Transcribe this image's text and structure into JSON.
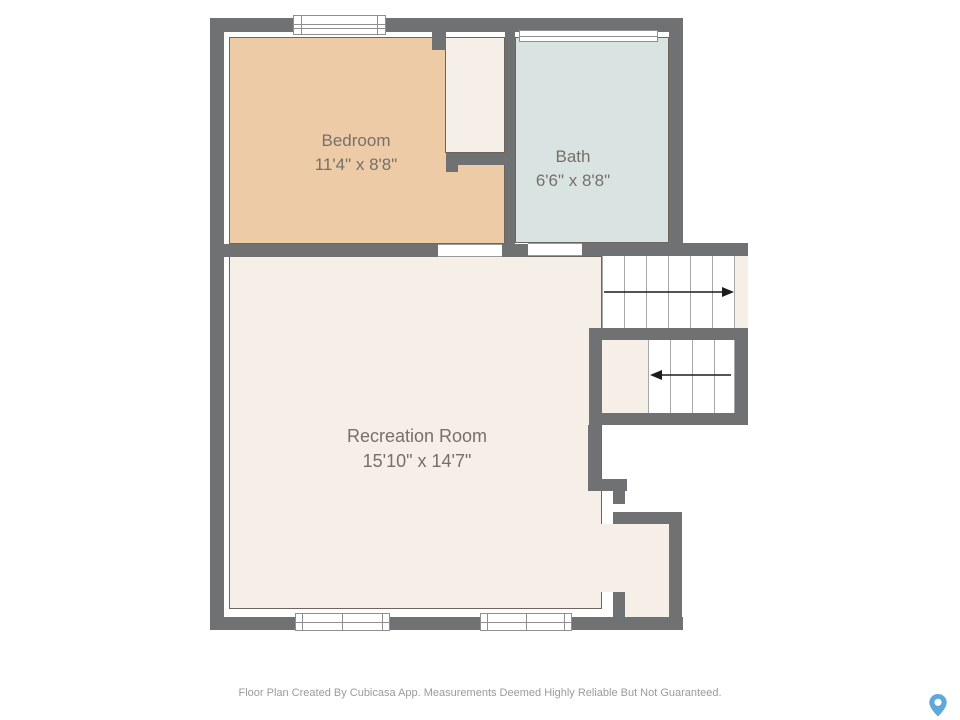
{
  "floor_plan": {
    "rooms": {
      "bedroom": {
        "name": "Bedroom",
        "dimensions": "11'4\" x 8'8\"",
        "fill": "#edcba6"
      },
      "bath": {
        "name": "Bath",
        "dimensions": "6'6\" x 8'8\"",
        "fill": "#d9e4e2"
      },
      "recreation_room": {
        "name": "Recreation Room",
        "dimensions": "15'10\" x 14'7\"",
        "fill": "#f6efe7"
      }
    },
    "stairs": {
      "upper_flight_arrow_direction": "right",
      "lower_flight_arrow_direction": "left"
    },
    "colors": {
      "wall": "#707173",
      "cream": "#f6efe7",
      "outline": "#6b665e",
      "tread": "#a8a8a8",
      "arrow": "#1c1c1c",
      "label_text": "#75706a",
      "footer_text": "#9b9b9b"
    }
  },
  "footer": {
    "disclaimer": "Floor Plan Created By Cubicasa App. Measurements Deemed Highly Reliable But Not Guaranteed."
  },
  "branding": {
    "map_pin_color": "#5fa8d9"
  }
}
